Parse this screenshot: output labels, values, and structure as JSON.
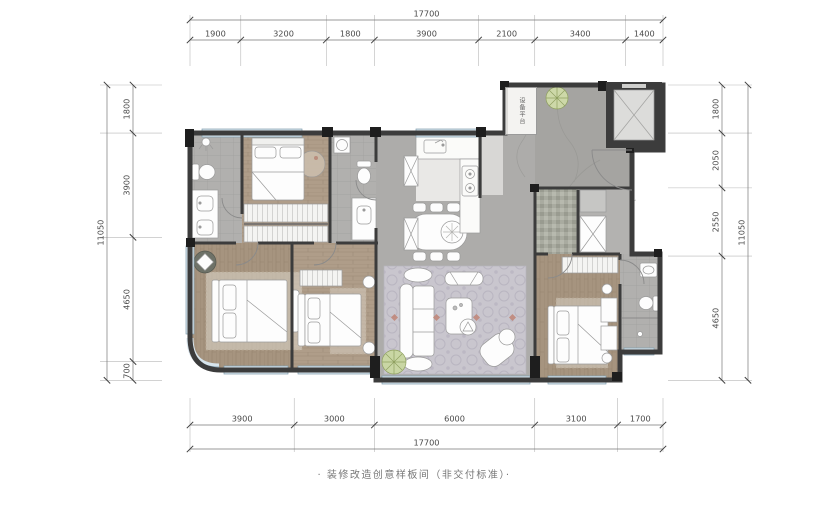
{
  "labels": {
    "equipment_platform": "设备平台",
    "caption": "· 装修改造创意样板间（非交付标准）·"
  },
  "dimensions": {
    "top": {
      "total": "17700",
      "segments": [
        "1900",
        "3200",
        "1800",
        "3900",
        "2100",
        "3400",
        "1400"
      ]
    },
    "bottom": {
      "total": "17700",
      "segments": [
        "3900",
        "3000",
        "6000",
        "3100",
        "1700"
      ]
    },
    "left": {
      "total": "11050",
      "segments": [
        "1800",
        "3900",
        "4650",
        "700"
      ]
    },
    "right": {
      "total": "11050",
      "segments": [
        "1800",
        "2050",
        "2550",
        "4650"
      ]
    }
  },
  "colors": {
    "wall": "#3c3c3c",
    "column": "#1e1e1e",
    "wood_floor": "#af9d89",
    "stone_floor": "#a5a4a1",
    "tile_floor": "#b1b0ae",
    "rug": "#c9c6ce",
    "window_glass": "#d7e4ec",
    "plant": "#c9d6a4",
    "accent": "#c08576",
    "dimension_text": "#4a4a4a"
  }
}
